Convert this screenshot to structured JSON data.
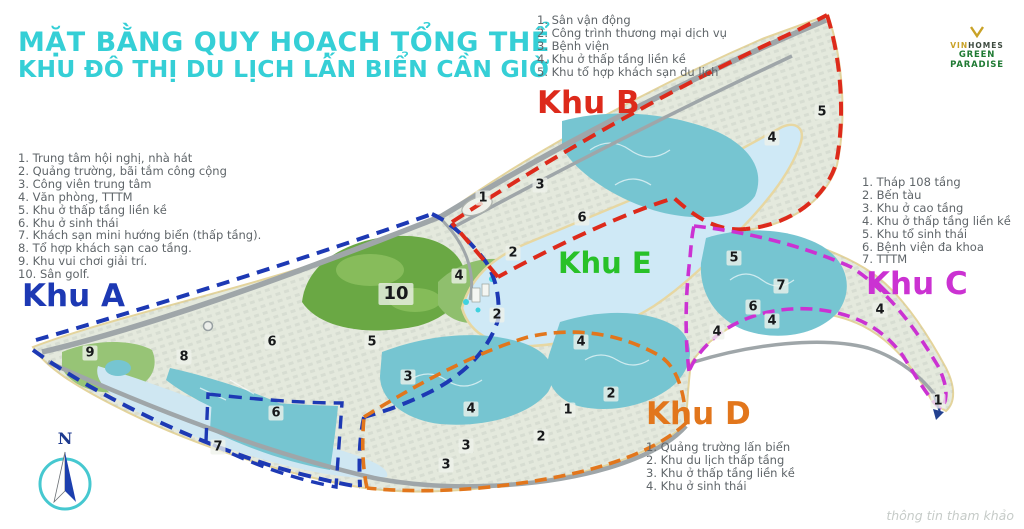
{
  "title": {
    "line1": "MẶT BẰNG QUY HOẠCH TỔNG THỂ",
    "line2": "KHU ĐÔ THỊ DU LỊCH LẤN BIỂN CẦN GIỜ"
  },
  "logo": {
    "brand_prefix": "VIN",
    "brand_suffix": "HOMES",
    "name": "GREEN PARADISE"
  },
  "watermark": "thông tin tham khảo",
  "compass": {
    "label": "N"
  },
  "colors": {
    "title": "#35cfd6",
    "zone_a": "#1d39b4",
    "zone_b": "#dd2a1b",
    "zone_c": "#cb32d2",
    "zone_d": "#e2761c",
    "zone_e": "#28c128",
    "lagoon": "#cfe9f6",
    "canal": "#76c5d1",
    "golf": "#6aa844",
    "land": "#e4e9dd"
  },
  "zones": {
    "A": {
      "label": "Khu A",
      "color": "#1d39b4",
      "items": [
        "Trung tâm hội nghị, nhà hát",
        "Quảng trường, bãi tắm công cộng",
        "Công viên trung tâm",
        "Văn phòng, TTTM",
        "Khu ở thấp tầng liền kề",
        "Khu ở sinh thái",
        "Khách sạn mini hướng biển (thấp tầng).",
        "Tổ hợp khách sạn cao tầng.",
        "Khu vui chơi giải trí.",
        "Sân golf."
      ]
    },
    "B": {
      "label": "Khu B",
      "color": "#dd2a1b",
      "items": [
        "Sân vận động",
        "Công trình thương mại dịch vụ",
        "Bệnh viện",
        "Khu ở thấp tầng liền kề",
        "Khu tổ hợp khách sạn du lịch"
      ]
    },
    "C": {
      "label": "Khu C",
      "color": "#cb32d2",
      "items": [
        "Tháp 108 tầng",
        "Bến tàu",
        "Khu ở cao tầng",
        "Khu ở thấp tầng liền kề",
        "Khu tổ sinh thái",
        "Bệnh viện đa khoa",
        "TTTM"
      ]
    },
    "D": {
      "label": "Khu D",
      "color": "#e2761c",
      "items": [
        "Quảng trường lấn biển",
        "Khu du lịch thấp tầng",
        "Khu ở thấp tầng liền kề",
        "Khu ở sinh thái"
      ]
    },
    "E": {
      "label": "Khu E",
      "color": "#28c128",
      "items": []
    }
  },
  "map_markers": [
    {
      "n": "9",
      "x": 90,
      "y": 353
    },
    {
      "n": "8",
      "x": 184,
      "y": 357
    },
    {
      "n": "6",
      "x": 272,
      "y": 342
    },
    {
      "n": "10",
      "x": 396,
      "y": 294
    },
    {
      "n": "5",
      "x": 372,
      "y": 342
    },
    {
      "n": "3",
      "x": 408,
      "y": 377
    },
    {
      "n": "6",
      "x": 276,
      "y": 413
    },
    {
      "n": "7",
      "x": 218,
      "y": 447
    },
    {
      "n": "4",
      "x": 459,
      "y": 276
    },
    {
      "n": "2",
      "x": 513,
      "y": 253
    },
    {
      "n": "2",
      "x": 497,
      "y": 315
    },
    {
      "n": "1",
      "x": 483,
      "y": 198
    },
    {
      "n": "3",
      "x": 540,
      "y": 185
    },
    {
      "n": "6",
      "x": 582,
      "y": 218
    },
    {
      "n": "4",
      "x": 772,
      "y": 138
    },
    {
      "n": "5",
      "x": 822,
      "y": 112
    },
    {
      "n": "5",
      "x": 734,
      "y": 258
    },
    {
      "n": "7",
      "x": 781,
      "y": 286
    },
    {
      "n": "6",
      "x": 753,
      "y": 307
    },
    {
      "n": "4",
      "x": 717,
      "y": 332
    },
    {
      "n": "4",
      "x": 772,
      "y": 321
    },
    {
      "n": "4",
      "x": 880,
      "y": 310
    },
    {
      "n": "1",
      "x": 938,
      "y": 401
    },
    {
      "n": "4",
      "x": 581,
      "y": 342
    },
    {
      "n": "2",
      "x": 611,
      "y": 394
    },
    {
      "n": "1",
      "x": 568,
      "y": 410
    },
    {
      "n": "4",
      "x": 471,
      "y": 409
    },
    {
      "n": "2",
      "x": 541,
      "y": 437
    },
    {
      "n": "3",
      "x": 466,
      "y": 446
    },
    {
      "n": "3",
      "x": 446,
      "y": 465
    }
  ]
}
